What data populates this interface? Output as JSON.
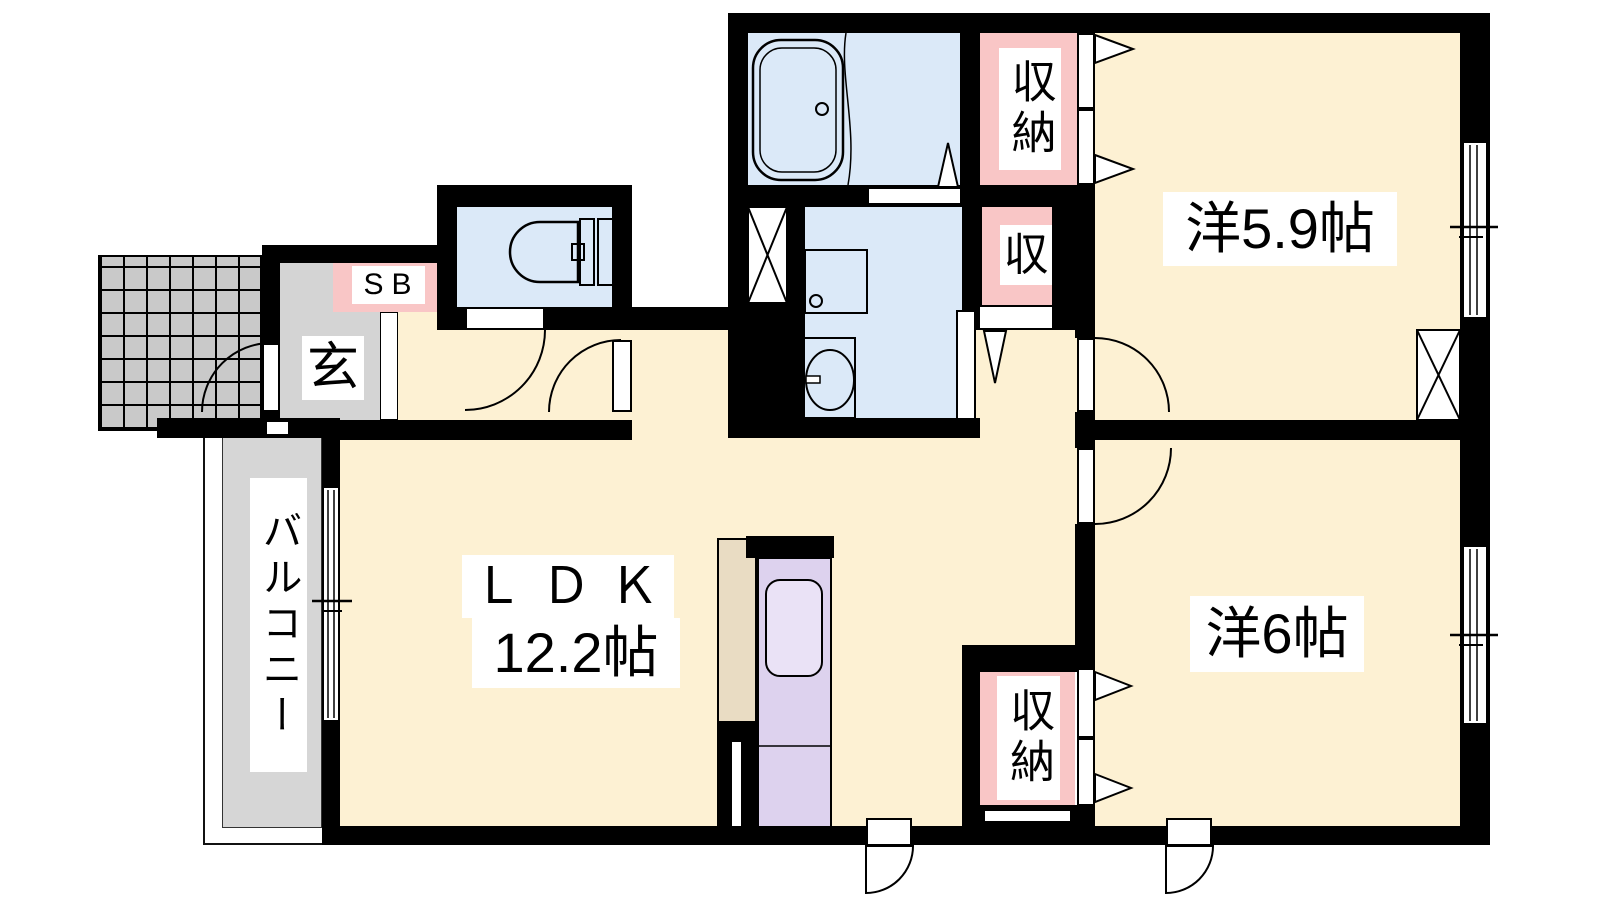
{
  "colors": {
    "wall": "#000000",
    "floor": "#fdf1d3",
    "water": "#dbe9f8",
    "pink": "#f9c6c6",
    "genkan": "#d4d4d4",
    "porch": "#c9c9c9",
    "balcony": "#d6d6d6",
    "purple": "#ddd2ee",
    "tan": "#e9dcc3",
    "sink": "#eae2f6",
    "labelbg": "#ffffff"
  },
  "labels": {
    "western_59": "洋5.9帖",
    "western_6": "洋6帖",
    "ldk_line1": "ＬＤＫ",
    "ldk_line2": "12.2帖",
    "balcony": "バルコニー",
    "entrance": "玄",
    "shoe_box": "SB",
    "storage_top": "収納",
    "storage_mid": "収",
    "storage_bottom": "収納"
  },
  "fixtures": [
    "bathtub",
    "toilet",
    "washbasin",
    "washing-machine",
    "kitchen-sink",
    "pipe-space-x",
    "pipe-space-x",
    "sliding-window",
    "sliding-window",
    "sliding-window",
    "swing-door",
    "folding-closet-door",
    "entrance-porch-tiles"
  ]
}
